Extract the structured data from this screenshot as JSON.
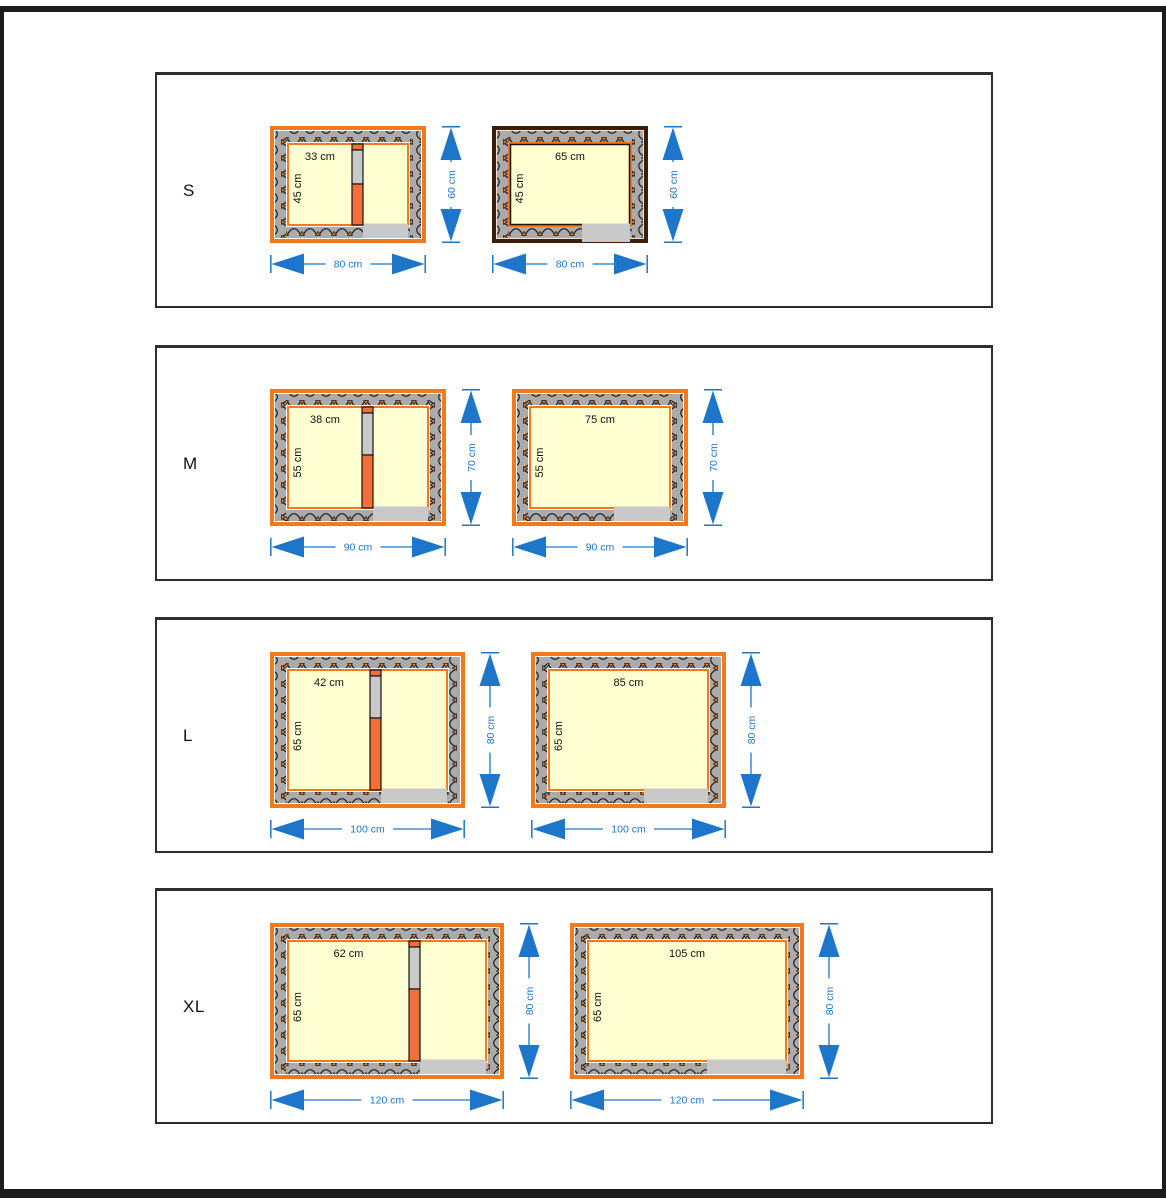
{
  "unit": "cm",
  "colors": {
    "page_frame": "#1c1c1c",
    "panel_border": "#2e2e2e",
    "panel_bg": "#ffffff",
    "orange_frame": "#f4791c",
    "divider_orange": "#f3703a",
    "wall_gray": "#ababab",
    "entrance_gray": "#c9c9c9",
    "divider_pass_gray": "#c9c9c9",
    "interior_cream": "#ffffd2",
    "hatch_stroke": "#141414",
    "dark_frame": "#3b1e05",
    "dark_frame_line": "#f6ddc1",
    "dimension_blue": "#1d76c9",
    "label_black": "#111111",
    "white": "#ffffff"
  },
  "scale_px_per_cm": 1.95,
  "rows": [
    {
      "label": "S",
      "diagrams": [
        {
          "variant": "divided",
          "frame": "orange",
          "outer_width_cm": 80,
          "outer_height_cm": 60,
          "compartment_width_cm": 33,
          "labels": {
            "inner_width": "33 cm",
            "inner_height": "45 cm",
            "outer_width": "80 cm",
            "outer_height": "60 cm"
          }
        },
        {
          "variant": "open",
          "frame": "dark",
          "outer_width_cm": 80,
          "outer_height_cm": 60,
          "labels": {
            "inner_width": "65 cm",
            "inner_height": "45 cm",
            "outer_width": "80 cm",
            "outer_height": "60 cm"
          }
        }
      ]
    },
    {
      "label": "M",
      "diagrams": [
        {
          "variant": "divided",
          "frame": "orange",
          "outer_width_cm": 90,
          "outer_height_cm": 70,
          "compartment_width_cm": 38,
          "labels": {
            "inner_width": "38 cm",
            "inner_height": "55 cm",
            "outer_width": "90 cm",
            "outer_height": "70 cm"
          }
        },
        {
          "variant": "open",
          "frame": "orange",
          "outer_width_cm": 90,
          "outer_height_cm": 70,
          "labels": {
            "inner_width": "75 cm",
            "inner_height": "55 cm",
            "outer_width": "90 cm",
            "outer_height": "70 cm"
          }
        }
      ]
    },
    {
      "label": "L",
      "diagrams": [
        {
          "variant": "divided",
          "frame": "orange",
          "outer_width_cm": 100,
          "outer_height_cm": 80,
          "compartment_width_cm": 42,
          "labels": {
            "inner_width": "42 cm",
            "inner_height": "65 cm",
            "outer_width": "100 cm",
            "outer_height": "80 cm"
          }
        },
        {
          "variant": "open",
          "frame": "orange",
          "outer_width_cm": 100,
          "outer_height_cm": 80,
          "labels": {
            "inner_width": "85 cm",
            "inner_height": "65 cm",
            "outer_width": "100 cm",
            "outer_height": "80 cm"
          }
        }
      ]
    },
    {
      "label": "XL",
      "diagrams": [
        {
          "variant": "divided",
          "frame": "orange",
          "outer_width_cm": 120,
          "outer_height_cm": 80,
          "compartment_width_cm": 62,
          "labels": {
            "inner_width": "62 cm",
            "inner_height": "65 cm",
            "outer_width": "120 cm",
            "outer_height": "80 cm"
          }
        },
        {
          "variant": "open",
          "frame": "orange",
          "outer_width_cm": 120,
          "outer_height_cm": 80,
          "labels": {
            "inner_width": "105 cm",
            "inner_height": "65 cm",
            "outer_width": "120 cm",
            "outer_height": "80 cm"
          }
        }
      ]
    }
  ]
}
